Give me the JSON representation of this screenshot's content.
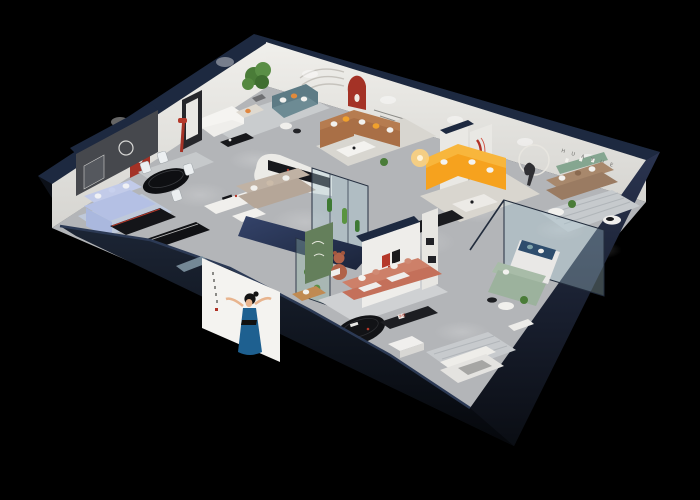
{
  "scene": {
    "description": "Isometric 3D cutaway render of a HuaYue furniture showroom floor plan on a black background",
    "background": "#000000"
  },
  "brand": {
    "logo_cn": "华悦",
    "wall_letters": "H U A Y U E",
    "logo_red": "#b5382a",
    "logo_black": "#1b1b1d"
  },
  "palette": {
    "floor": "#b3b5b8",
    "wall": "#ebeae6",
    "wall_cap": "#1d2940",
    "accent_wall": "#46484d",
    "arch_red": "#a43226",
    "periwinkle": "#b4c0e4",
    "rug_blue": "#bfc9da",
    "teal": "#5d7b85",
    "taupe": "#b5a698",
    "caramel": "#a96f46",
    "orange": "#f6a21e",
    "coral": "#c4705a",
    "sage": "#9cb29d",
    "brown": "#9a7b62",
    "navy_cushion": "#2e4d6d",
    "canopy_navy": "#2c3a58",
    "glass": "rgba(173,203,214,0.35)",
    "plant": "#4a7c38",
    "dress_blue": "#1e6090",
    "table_black": "#121316"
  },
  "rooms": [
    {
      "label": "blue sofa lounge",
      "items": [
        "periwinkle sectional sofa",
        "black media console",
        "long black TV lowboard",
        "light blue rug"
      ]
    },
    {
      "label": "dining area",
      "items": [
        "black oval dining table",
        "4 white chairs",
        "red arched niche",
        "charcoal accent wall with framed art",
        "white sideboard"
      ]
    },
    {
      "label": "teal lounge",
      "items": [
        "teal sofa",
        "cream armchair",
        "white sofa",
        "potted tree",
        "black coffee table",
        "round side tables",
        "wall arc decor"
      ]
    },
    {
      "label": "cream lounge",
      "items": [
        "curved white half wall",
        "black sideboard",
        "taupe fabric sofa",
        "white side table"
      ]
    },
    {
      "label": "caramel lounge",
      "items": [
        "caramel leather corner sofa",
        "orange and white pillows",
        "white coffee table",
        "red arched niche",
        "wall slogan"
      ]
    },
    {
      "label": "orange lounge",
      "items": [
        "orange corner sofa",
        "lit table lamp",
        "marble coffee table",
        "black media bar",
        "runner sculpture with light ring",
        "red ribbon art pillar"
      ]
    },
    {
      "label": "huayue letter room",
      "items": [
        "brown leather sofa",
        "green display ledge",
        "HUAYUE wall letters",
        "striped rug",
        "round side tables",
        "plant"
      ]
    },
    {
      "label": "glass bedroom",
      "items": [
        "glass partitions",
        "white day bed",
        "navy cushion",
        "sage green sofa",
        "round tables",
        "plant"
      ]
    },
    {
      "label": "glass gallery",
      "items": [
        "navy canopy",
        "glass display cases",
        "cactus plants"
      ]
    },
    {
      "label": "brand lounge",
      "items": [
        "logo wall 华悦",
        "coral sofa with white cushions",
        "teddy bear sculpture",
        "green art panel",
        "black oval coffee table",
        "white ottoman",
        "black display console",
        "tan armchair"
      ]
    },
    {
      "label": "front bedroom",
      "items": [
        "white bed",
        "gray blanket",
        "striped rug",
        "white cabinet"
      ]
    },
    {
      "label": "facade",
      "items": [
        "poster of woman in blue dress",
        "dark navy exterior walls"
      ]
    }
  ]
}
